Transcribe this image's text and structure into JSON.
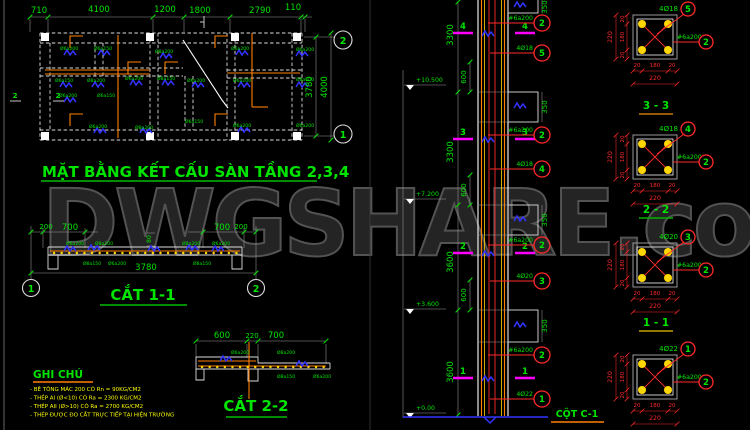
{
  "colors": {
    "green": "#00e400",
    "orange": "#ff8000",
    "yellow": "#ffff00",
    "red": "#ff2a2a",
    "blue": "#3333ff",
    "magenta": "#ff00ff",
    "gold": "#ffd700"
  },
  "watermark": "DWGSHARE.com",
  "plan": {
    "title": "MẶT BẰNG KẾT CẤU SÀN TẦNG 2,3,4",
    "dims_top": [
      "710",
      "4100",
      "1200",
      "1800",
      "2790",
      "110"
    ],
    "dim_3780": "3780",
    "dim_4000": "4000",
    "bubble_top": "2",
    "bubble_bottom": "1",
    "cut_left_a": "2",
    "cut_left_b": "2",
    "tiny_labels": [
      {
        "x": 60,
        "y": 50,
        "t": "Ø6a200"
      },
      {
        "x": 94,
        "y": 50,
        "t": "Ø6a150"
      },
      {
        "x": 155,
        "y": 53,
        "t": "Ø8a200"
      },
      {
        "x": 231,
        "y": 50,
        "t": "Ø6a200"
      },
      {
        "x": 296,
        "y": 51,
        "t": "Ø6a200"
      },
      {
        "x": 55,
        "y": 82,
        "t": "Ø6a150"
      },
      {
        "x": 87,
        "y": 82,
        "t": "Ø8a200"
      },
      {
        "x": 125,
        "y": 80,
        "t": "Ø6a200"
      },
      {
        "x": 157,
        "y": 80,
        "t": "Ø8a150"
      },
      {
        "x": 187,
        "y": 82,
        "t": "Ø6a200"
      },
      {
        "x": 233,
        "y": 82,
        "t": "Ø6a200"
      },
      {
        "x": 296,
        "y": 81,
        "t": "Ø8a200"
      },
      {
        "x": 59,
        "y": 97,
        "t": "Ø6a200"
      },
      {
        "x": 97,
        "y": 97,
        "t": "Ø6a150"
      },
      {
        "x": 89,
        "y": 128,
        "t": "Ø6a200"
      },
      {
        "x": 135,
        "y": 129,
        "t": "Ø8a200"
      },
      {
        "x": 185,
        "y": 123,
        "t": "Ø6a150"
      },
      {
        "x": 233,
        "y": 127,
        "t": "Ø6a200"
      },
      {
        "x": 296,
        "y": 127,
        "t": "Ø6a200"
      }
    ]
  },
  "cut11": {
    "title": "CẮT 1-1",
    "d200l": "200",
    "d700l": "700",
    "d80": "80",
    "d700r": "700",
    "d200r": "200",
    "d3780": "3780",
    "bubble_left": "1",
    "bubble_right": "2",
    "tiny_labels": [
      {
        "x": 66,
        "y": 245,
        "t": "Ø6a200"
      },
      {
        "x": 95,
        "y": 245,
        "t": "Ø8a200"
      },
      {
        "x": 182,
        "y": 245,
        "t": "Ø8a200"
      },
      {
        "x": 212,
        "y": 245,
        "t": "Ø6a200"
      },
      {
        "x": 83,
        "y": 265,
        "t": "Ø8a150"
      },
      {
        "x": 108,
        "y": 265,
        "t": "Ø6a200"
      },
      {
        "x": 193,
        "y": 265,
        "t": "Ø8a150"
      }
    ]
  },
  "cut22": {
    "title": "CẮT 2-2",
    "d600": "600",
    "d220": "220",
    "d700": "700",
    "tiny_labels": [
      {
        "x": 231,
        "y": 354,
        "t": "Ø6a200"
      },
      {
        "x": 277,
        "y": 354,
        "t": "Ø8a200"
      },
      {
        "x": 277,
        "y": 378,
        "t": "Ø8a150"
      },
      {
        "x": 313,
        "y": 378,
        "t": "Ø6a200"
      }
    ]
  },
  "notes": {
    "title": "GHI CHÚ",
    "lines": [
      "- BÊ TÔNG MÁC 200 CÓ Rn = 90KG/CM2",
      "- THÉP AI (Ø<10) CÓ Ra = 2300 KG/CM2",
      "- THÉP AII (Ø>10) CÓ Ra = 2700 KG/CM2",
      "- THÉP ĐƯỢC ĐO CẮT TRỰC TIẾP TẠI HIỆN TRƯỜNG"
    ]
  },
  "elevation": {
    "title": "CỘT C-1",
    "levels": [
      "+10.500",
      "+7.200",
      "+3.600",
      "+0.00"
    ],
    "zone_dims": [
      "3300",
      "3300",
      "3600",
      "3600"
    ],
    "lap_dims": [
      "600",
      "600",
      "600"
    ],
    "beam_dims": [
      "350",
      "350",
      "350",
      "350"
    ],
    "cut_marks": [
      "4",
      "3",
      "2",
      "1"
    ],
    "labels": [
      {
        "text": "#6a200",
        "bubble": "2"
      },
      {
        "text": "4Ø18",
        "bubble": "5"
      },
      {
        "text": "#6a200",
        "bubble": "2"
      },
      {
        "text": "4Ø18",
        "bubble": "4"
      },
      {
        "text": "#6a200",
        "bubble": "2"
      },
      {
        "text": "4Ø20",
        "bubble": "3"
      },
      {
        "text": "#6a200",
        "bubble": "2"
      },
      {
        "text": "4Ø22",
        "bubble": "1"
      }
    ]
  },
  "sections": [
    {
      "title": "3 - 3",
      "bar": "4Ø18",
      "bar_bubble": "5",
      "stirrup": "#6a200",
      "stirrup_bubble": "2",
      "side": [
        "20",
        "180",
        "20"
      ],
      "side_total": "220",
      "bottom": [
        "20",
        "180",
        "20"
      ],
      "bottom_total": "220",
      "underline": "#c87800"
    },
    {
      "title": "2 - 2",
      "bar": "4Ø18",
      "bar_bubble": "4",
      "stirrup": "#6a200",
      "stirrup_bubble": "2",
      "side": [
        "20",
        "180",
        "20"
      ],
      "side_total": "220",
      "bottom": [
        "20",
        "180",
        "20"
      ],
      "bottom_total": "220",
      "underline": "#00b400"
    },
    {
      "title": "1 - 1",
      "bar": "4Ø20",
      "bar_bubble": "3",
      "stirrup": "#6a200",
      "stirrup_bubble": "2",
      "side": [
        "20",
        "180",
        "20"
      ],
      "side_total": "220",
      "bottom": [
        "20",
        "180",
        "20"
      ],
      "bottom_total": "220",
      "underline": "#c8a000"
    },
    {
      "title": "",
      "bar": "4Ø22",
      "bar_bubble": "1",
      "stirrup": "#6a200",
      "stirrup_bubble": "2",
      "side": [
        "20",
        "180",
        "20"
      ],
      "side_total": "220",
      "bottom": [
        "20",
        "180",
        "20"
      ],
      "bottom_total": "220",
      "underline": "#c87800"
    }
  ]
}
